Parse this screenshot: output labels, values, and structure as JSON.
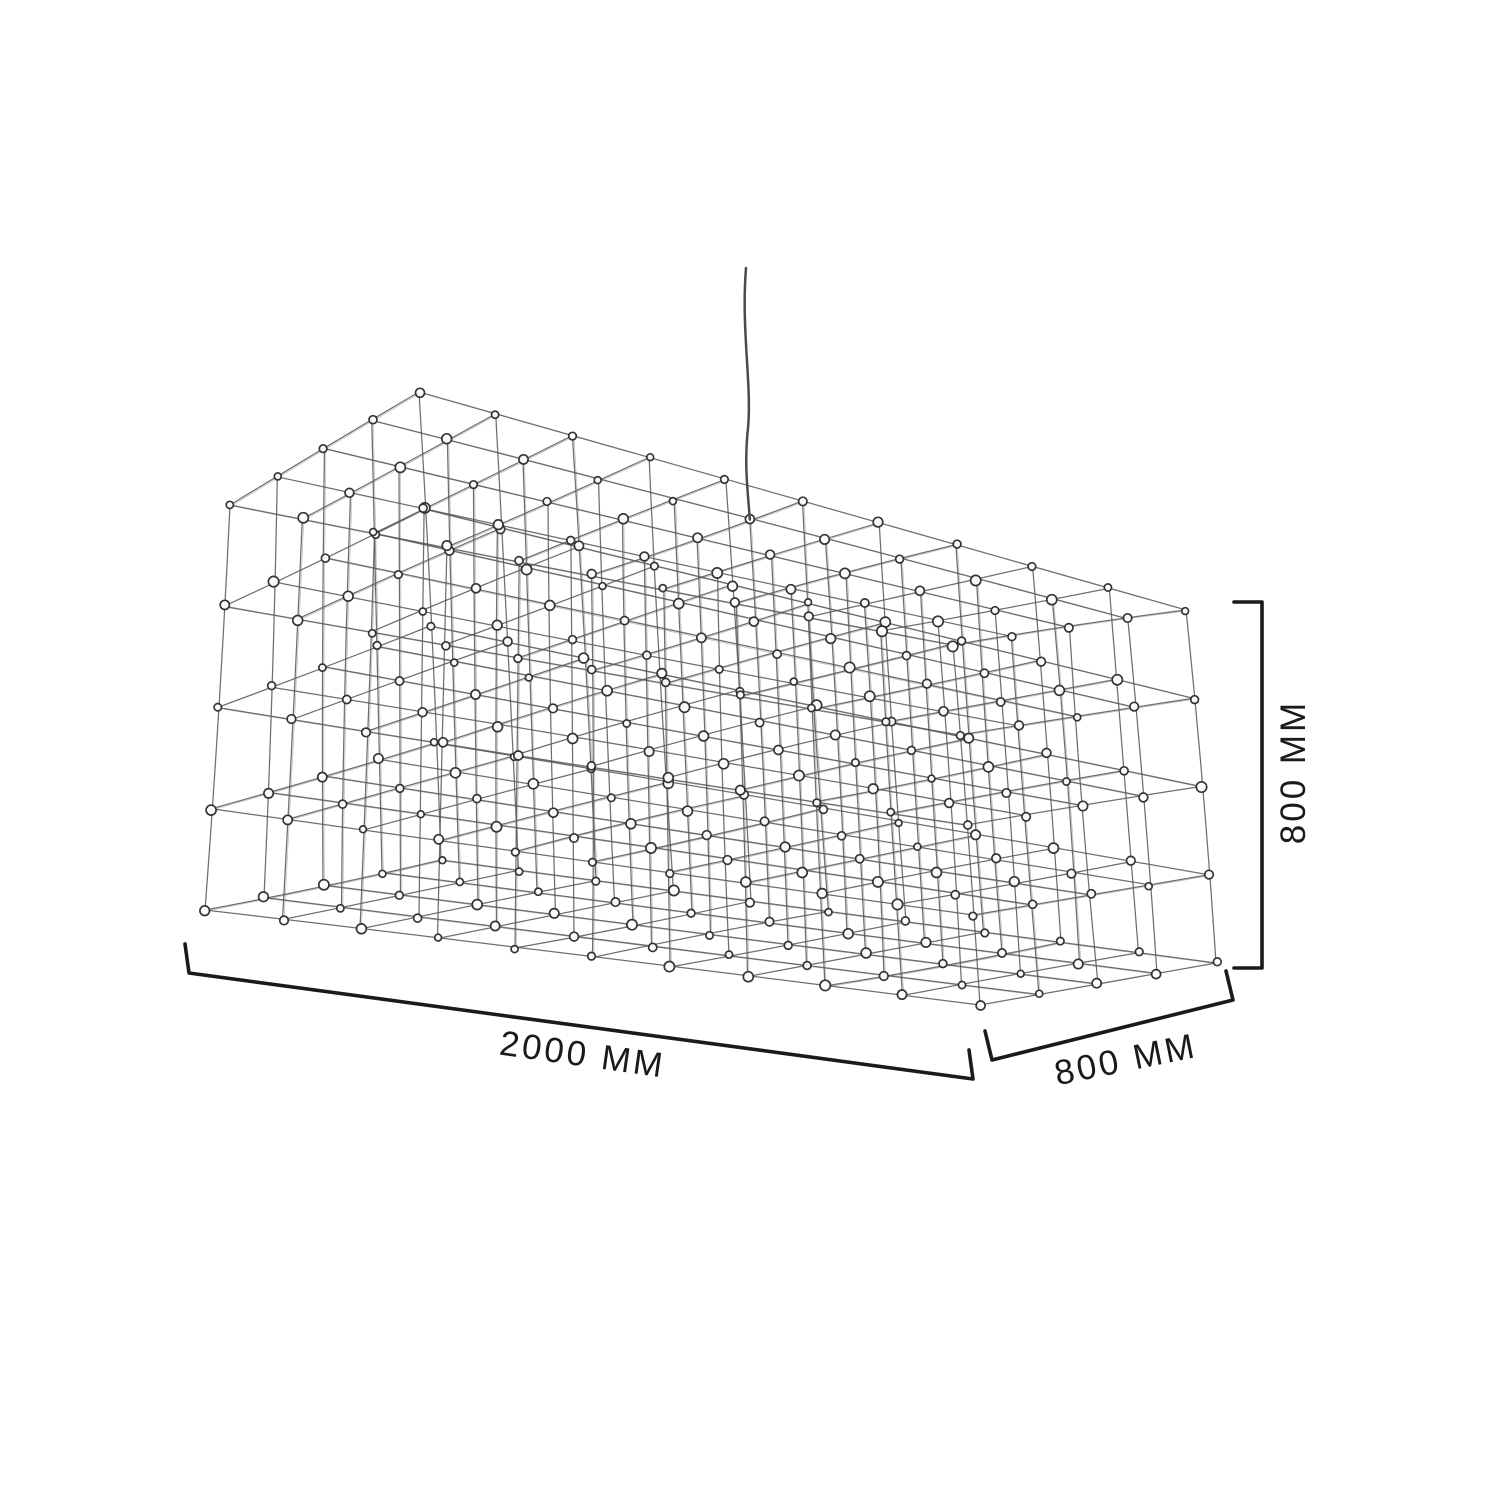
{
  "drawing": {
    "title": "wireframe grid pendant dimension drawing",
    "dimensions": {
      "length_label": "2000 MM",
      "depth_label": "800 MM",
      "height_label": "800 MM"
    },
    "structure": {
      "length_mm": 2000,
      "depth_mm": 800,
      "height_mm": 800,
      "cells_length": 10,
      "cells_depth": 4,
      "cells_height": 4
    },
    "colors": {
      "background": "#ffffff",
      "wire": "#5a5a5a",
      "node_stroke": "#2e2e2e",
      "node_fill": "#ffffff",
      "dimension": "#1a1a1a",
      "cable": "#4a4a4a"
    }
  }
}
